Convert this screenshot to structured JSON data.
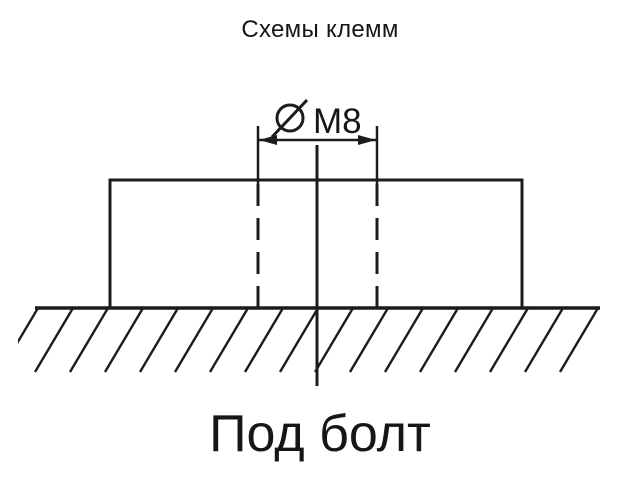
{
  "title": "Схемы клемм",
  "diagram": {
    "dimension": {
      "symbol": "Ø",
      "value": "M8",
      "full_label": "ØM8"
    },
    "caption": "Под болт"
  },
  "colors": {
    "ink": "#1c1c1c",
    "background": "#ffffff"
  }
}
